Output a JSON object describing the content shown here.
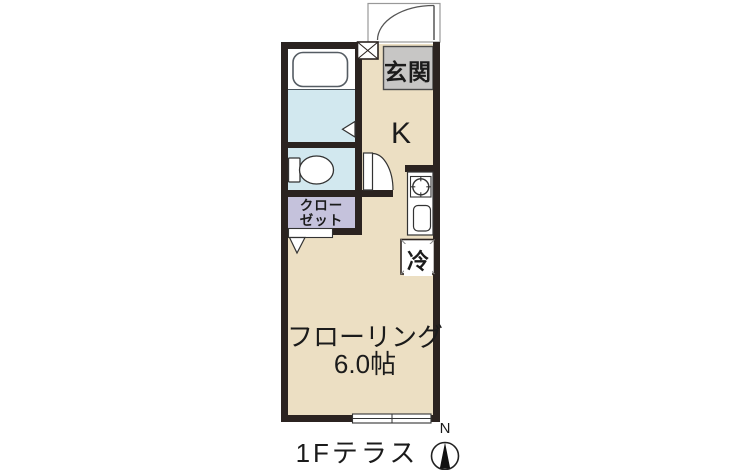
{
  "plan": {
    "labels": {
      "entrance": "玄関",
      "kitchen": "K",
      "closet_line1": "クロー",
      "closet_line2": "ゼット",
      "fridge": "冷",
      "room_line1": "フローリング",
      "room_line2": "6.0帖",
      "terrace": "1Fテラス",
      "compass_north": "N"
    },
    "colors": {
      "wall": "#2b2320",
      "floor": "#ecdfc3",
      "wet_area": "#d2e8ef",
      "closet": "#c5c2dc",
      "entrance_area": "#c7c6c5",
      "fixture_outline": "#333333"
    }
  }
}
